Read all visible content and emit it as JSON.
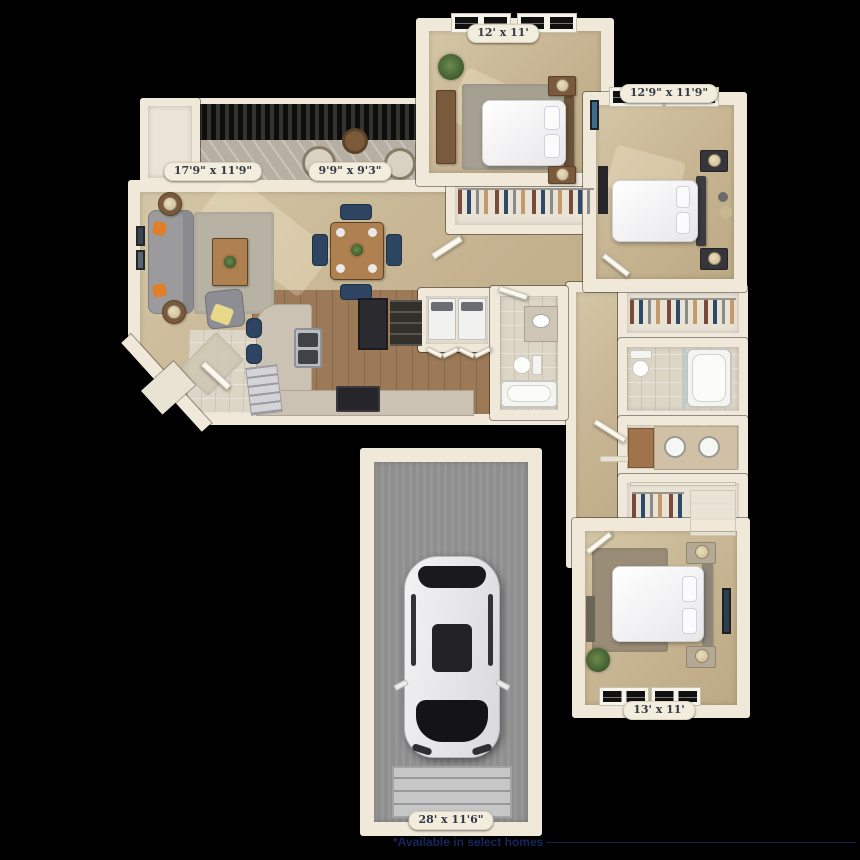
{
  "canvas": {
    "background": "#000000"
  },
  "rooms": {
    "bedroom_top": {
      "label": "12' x 11'"
    },
    "bedroom_right": {
      "label": "12'9\" x 11'9\""
    },
    "living_room": {
      "label": "17'9\" x 11'9\""
    },
    "dining_room": {
      "label": "9'9\" x 9'3\""
    },
    "bedroom_bottom": {
      "label": "13' x 11'"
    },
    "garage": {
      "label": "28' x 11'6\""
    }
  },
  "footer": {
    "note": "*Available in select homes"
  },
  "colors": {
    "wall": "#f0e9da",
    "carpet": "#c8b694",
    "wood_floor": "#9c7a58",
    "tile": "#ddd6c6",
    "concrete": "#8f8f8f",
    "label_text": "#333945",
    "note_text": "#17255c",
    "accent_navy": "#2d4560",
    "accent_orange": "#e07f28"
  }
}
